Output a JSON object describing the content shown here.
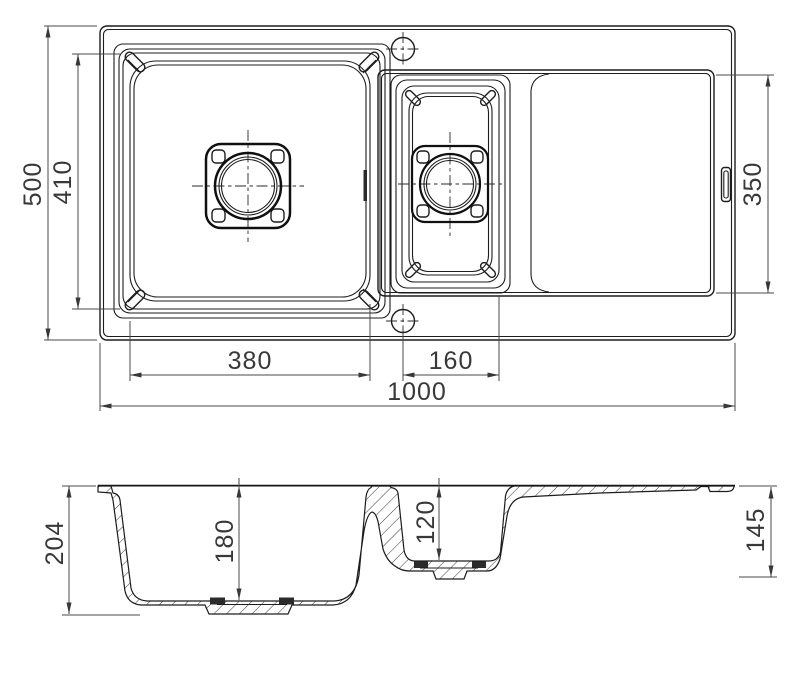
{
  "drawing": {
    "description": "Technical dimension drawing of a kitchen sink with main bowl, half bowl and drainer: plan view (top) and cross-section view (bottom)",
    "plan_dims": {
      "overall_width": "1000",
      "overall_depth": "500",
      "bowls_inner_depth": "410",
      "main_bowl_width": "380",
      "half_bowl_width": "160",
      "drainer_length": "350"
    },
    "section_dims": {
      "overall_height": "204",
      "main_bowl_depth": "180",
      "half_bowl_depth": "120",
      "end_height": "145"
    },
    "colors": {
      "line": "#1d1d1d",
      "dim": "#4a4a4a",
      "bg": "#ffffff"
    }
  }
}
